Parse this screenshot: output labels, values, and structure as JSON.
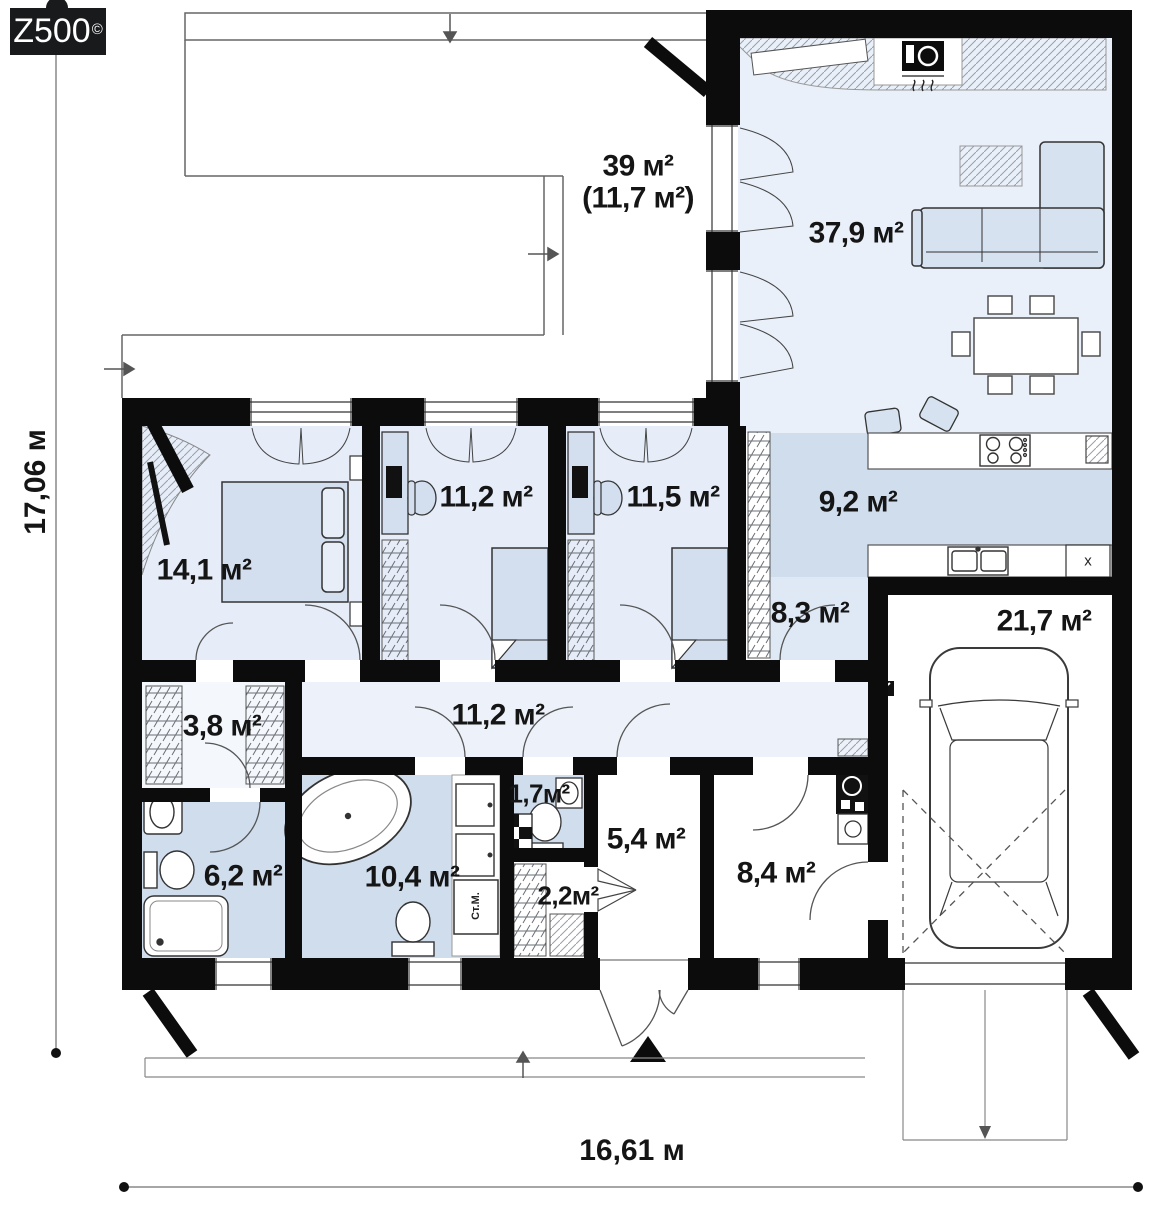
{
  "logo": {
    "text": "Z500",
    "mark": "©"
  },
  "dimensions": {
    "vertical": "17,06 м",
    "horizontal": "16,61 м"
  },
  "rooms": [
    {
      "id": "terrace",
      "label": "39 м²",
      "sublabel": "(11,7 м²)"
    },
    {
      "id": "living-room",
      "label": "37,9 м²"
    },
    {
      "id": "bedroom-main",
      "label": "14,1 м²"
    },
    {
      "id": "bedroom-2",
      "label": "11,2 м²"
    },
    {
      "id": "bedroom-3",
      "label": "11,5 м²"
    },
    {
      "id": "kitchen",
      "label": "9,2 м²"
    },
    {
      "id": "hallway",
      "label": "8,3 м²"
    },
    {
      "id": "garage",
      "label": "21,7 м²"
    },
    {
      "id": "walk-in-closet",
      "label": "3,8 м²"
    },
    {
      "id": "corridor",
      "label": "11,2 м²"
    },
    {
      "id": "bathroom-1",
      "label": "6,2 м²"
    },
    {
      "id": "bathroom-2",
      "label": "10,4 м²"
    },
    {
      "id": "wc",
      "label": "1,7м²"
    },
    {
      "id": "storage",
      "label": "2,2м²"
    },
    {
      "id": "entry-hall",
      "label": "5,4 м²"
    },
    {
      "id": "utility-room",
      "label": "8,4 м²"
    }
  ],
  "labels": {
    "washing_machine": "Ст.М.",
    "dishwasher_mark": "x"
  },
  "colors": {
    "wall": "#0c0c0c",
    "floor_light": "#e6edf8",
    "floor_blue": "#cfdded",
    "floor_corridor": "#edf2fa",
    "furniture": "#d3dfef",
    "line": "#555555"
  }
}
